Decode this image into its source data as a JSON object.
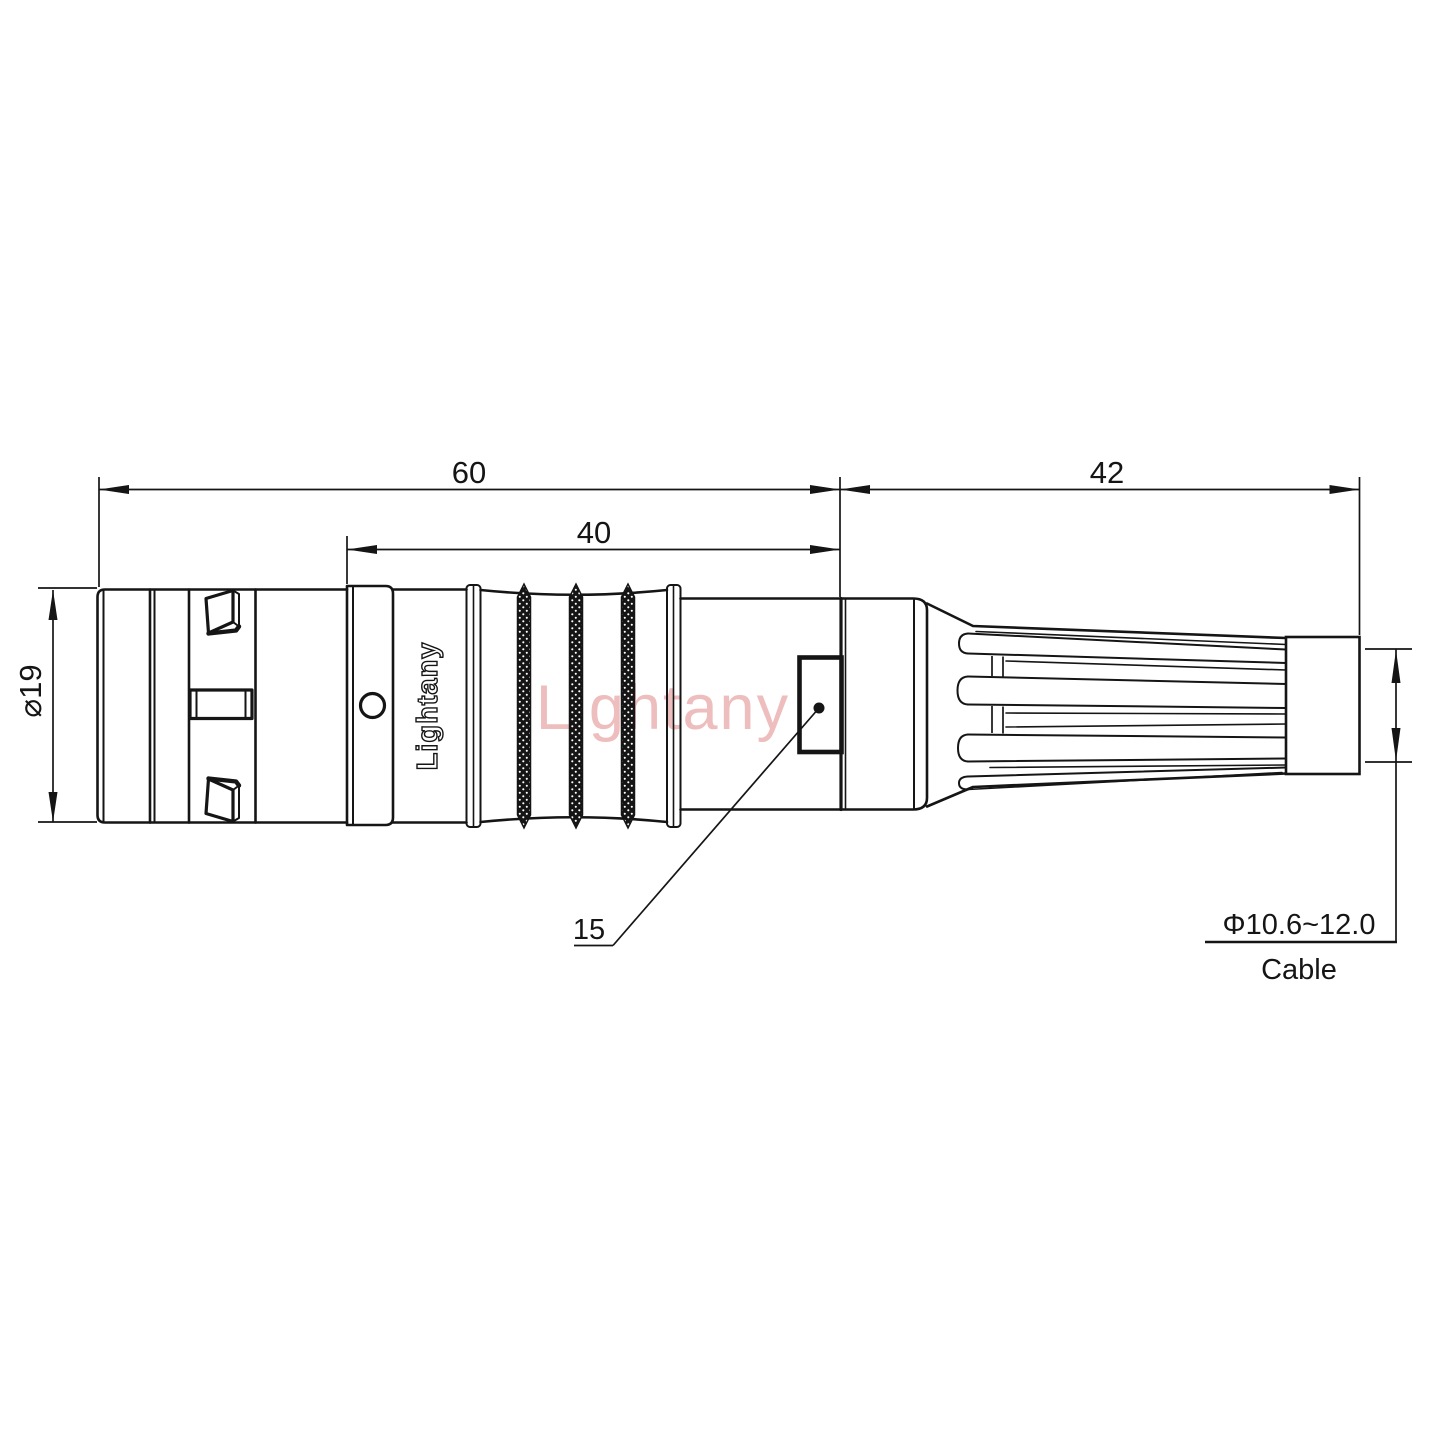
{
  "drawing": {
    "watermark": "Lightany",
    "brand_marking": "Lightany",
    "dimensions": {
      "total_length": "60",
      "grip_length": "40",
      "boot_length": "42",
      "body_diameter": "⌀19",
      "latch_size": "15",
      "cable_diameter_range": "Φ10.6~12.0",
      "cable_label": "Cable"
    },
    "colors": {
      "line": "#151515",
      "watermark": "#eebdbd",
      "background": "#ffffff"
    }
  }
}
